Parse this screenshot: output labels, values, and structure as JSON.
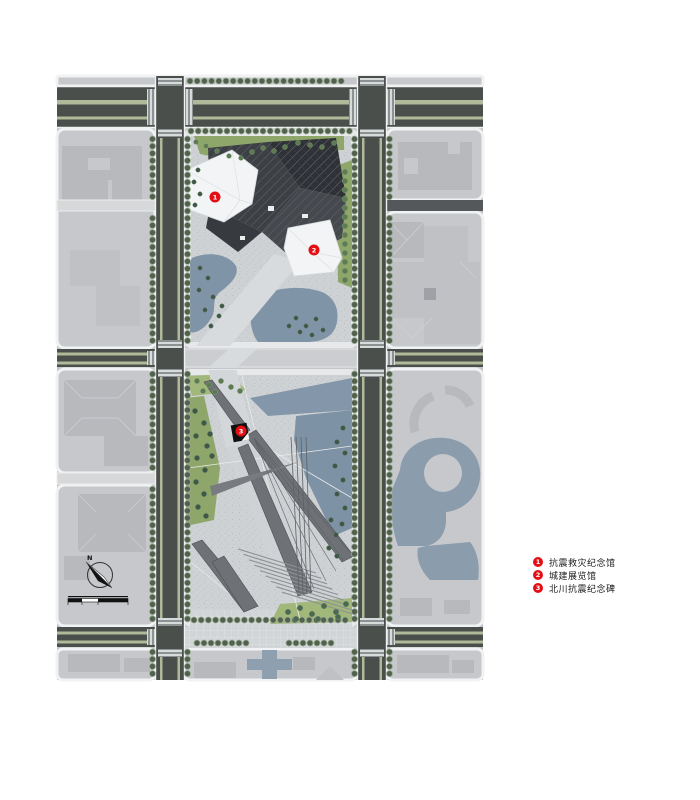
{
  "title": "memorial-site-master-plan",
  "legend": {
    "items": [
      {
        "num": "1",
        "label": "抗震救灾纪念馆"
      },
      {
        "num": "2",
        "label": "城建展览馆"
      },
      {
        "num": "3",
        "label": "北川抗震纪念碑"
      }
    ]
  },
  "compass": {
    "north_label": "N"
  },
  "colors": {
    "accent_red": "#e40f15",
    "water": "#7e92a5",
    "vegetation": "#8fa66b",
    "road_asphalt": "#4a4f4b",
    "road_median": "#b0ba9a",
    "block_gray": "#c6c8cb",
    "roof_dark": "#35383c",
    "building_white": "#f3f4f6"
  }
}
